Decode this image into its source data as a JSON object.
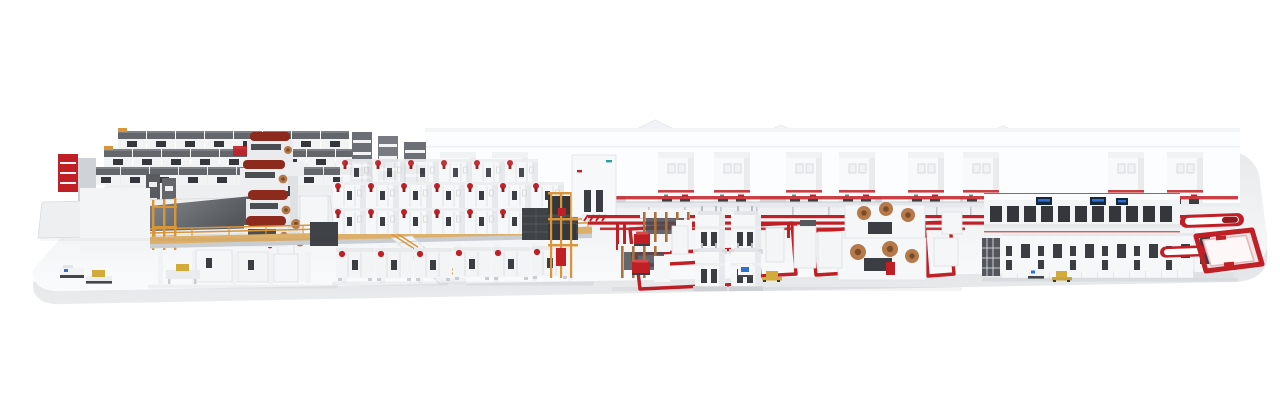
{
  "scene": {
    "title": "Industrial production line 3D render",
    "description": "Isometric photorealistic rendering of a long white and red industrial production line displayed on a rounded white platform: automated roll storage racks, a mezzanine with splicers and paper rolls, double-deck process modules, red floor conveyor loops with tower machines, roll winders, a glass finishing line with control screens, end-of-line conveyor loops and small AGV shuttles."
  },
  "palette": {
    "bg": "#ffffff",
    "red": "#c01f26",
    "red_dark": "#8f1a1f",
    "orange": "#d8953a",
    "deck_tan": "#dcb06a",
    "wood": "#a9713f",
    "copper": "#b5794a",
    "copper_dark": "#7a4c28",
    "maroon": "#8c2a1d",
    "panel_dark": "#3a3d42",
    "steel": "#9aa0a6",
    "steel_dark": "#63676c",
    "screen_navy": "#16263b",
    "screen_blue": "#2e6fd4",
    "yellow": "#d2ab3a",
    "teal": "#2ba39b",
    "platform_top_light": "#f9fafb",
    "platform_top_shade": "#e7e9eb",
    "platform_face": "#d6d8db"
  },
  "sections": [
    {
      "id": "platform",
      "label": "Rounded display platform"
    },
    {
      "id": "factory-backdrop",
      "label": "Factory buildings backdrop with gable roofs"
    },
    {
      "id": "cabinet-row",
      "label": "Row of electrical cabinets along back wall"
    },
    {
      "id": "roll-storage",
      "label": "Automated roll storage racks"
    },
    {
      "id": "infeed-table",
      "label": "Infeed conveyor table with ramp"
    },
    {
      "id": "splicer-mezzanine",
      "label": "Splicer mezzanine with paper rolls and orange railings"
    },
    {
      "id": "process-decks",
      "label": "Double-deck process line modules with red valves"
    },
    {
      "id": "process-tower",
      "label": "Process tower and orange scaffold"
    },
    {
      "id": "floor-loops",
      "label": "Red floor conveyor track and loops"
    },
    {
      "id": "tower-cluster",
      "label": "Tower machines and wood-frame units with red carts"
    },
    {
      "id": "winder-cluster",
      "label": "Roll winder machines with copper rolls"
    },
    {
      "id": "finishing-line",
      "label": "Finishing line with control screens"
    },
    {
      "id": "end-conveyors",
      "label": "End-of-line red conveyor loops"
    },
    {
      "id": "agv-shuttles",
      "label": "AGV shuttles and pallet trucks"
    }
  ]
}
